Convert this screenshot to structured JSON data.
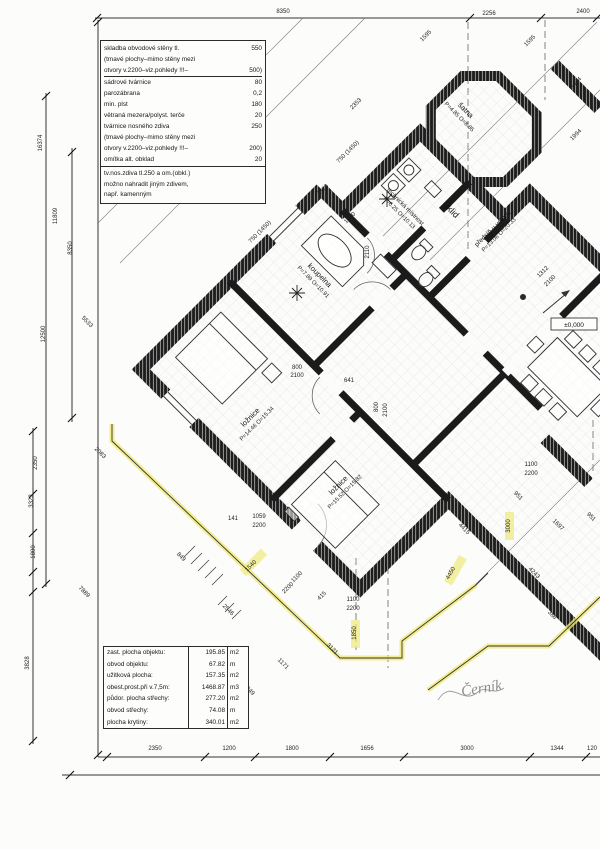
{
  "spec_box": {
    "lines": [
      {
        "l": "skladba obvodové stěny tl.",
        "v": "550"
      },
      {
        "l": "(tmavé plochy–mimo stěny mezi",
        "v": ""
      },
      {
        "l": "otvory v.2200–viz.pohledy !!!–",
        "v": "500)"
      },
      {
        "l": "sádrové tvárnice",
        "v": "80"
      },
      {
        "l": "parozábrana",
        "v": "0,2"
      },
      {
        "l": "min. plst",
        "v": "180"
      },
      {
        "l": "větraná mezera/polyst. terče",
        "v": "20"
      },
      {
        "l": "tvárnice nosného zdiva",
        "v": "250"
      },
      {
        "l": "(tmavé plochy–mimo stěny mezi",
        "v": ""
      },
      {
        "l": "otvory v.2200–viz.pohledy !!!–",
        "v": "200)"
      },
      {
        "l": "omítka alt. obklad",
        "v": "20"
      }
    ],
    "notes": [
      "tv.nos.zdiva tl.250 a om.(obkl.)",
      "možno nahradit jiným zdivem,",
      "např. kamenným"
    ]
  },
  "area_table": {
    "rows": [
      {
        "label": "zast. plocha objektu:",
        "value": "195.85",
        "unit": "m2"
      },
      {
        "label": "obvod objektu:",
        "value": "67.82",
        "unit": "m"
      },
      {
        "label": "užitková plocha:",
        "value": "157.35",
        "unit": "m2"
      },
      {
        "label": "obest.prost.při v.7,5m:",
        "value": "1468.87",
        "unit": "m3"
      },
      {
        "label": "půdor. plocha střechy:",
        "value": "277.20",
        "unit": "m2"
      },
      {
        "label": "obvod střechy:",
        "value": "74.08",
        "unit": "m"
      },
      {
        "label": "plocha krytiny:",
        "value": "340.01",
        "unit": "m2"
      }
    ]
  },
  "rooms": [
    {
      "n": "koupelna",
      "s": "P=7.89  O=10.91",
      "x": 318,
      "y": 277,
      "r": 45
    },
    {
      "n": "ložnice",
      "s": "P=14.46  O=15.34",
      "x": 252,
      "y": 419,
      "r": -45
    },
    {
      "n": "ložnice",
      "s": "P=15.52  O=15.82",
      "x": 340,
      "y": 487,
      "r": -45
    },
    {
      "n": "technická místnost",
      "s": "P=6.25  O=10.13",
      "x": 404,
      "y": 208,
      "r": 45,
      "fs": 6
    },
    {
      "n": "úklid",
      "x": 449,
      "y": 212,
      "r": 45,
      "fs": 9
    },
    {
      "n": "šatna",
      "s": "P=4.85  O=8.85",
      "x": 464,
      "y": 112,
      "r": 45
    },
    {
      "n": "předsíň u vstupu",
      "s": "P=13.06  O=20.33",
      "x": 494,
      "y": 230,
      "r": -45,
      "fs": 6.5
    }
  ],
  "dims": [
    [
      "8350",
      283,
      13,
      0
    ],
    [
      "2256",
      489,
      15,
      0
    ],
    [
      "2400",
      583,
      13,
      0
    ],
    [
      "1595",
      427,
      37,
      -45
    ],
    [
      "1595",
      531,
      42,
      -45
    ],
    [
      "1694",
      577,
      84,
      -45
    ],
    [
      "1994",
      577,
      136,
      -45
    ],
    [
      "2353",
      357,
      105,
      -45
    ],
    [
      "16374",
      42,
      143,
      -90
    ],
    [
      "11809",
      57,
      216,
      -90
    ],
    [
      "8350",
      72,
      248,
      -90
    ],
    [
      "12500",
      45,
      334,
      -90
    ],
    [
      "2350",
      37,
      463,
      -90
    ],
    [
      "3323",
      33,
      501,
      -90
    ],
    [
      "1800",
      35,
      552,
      -90
    ],
    [
      "3828",
      29,
      663,
      -90
    ],
    [
      "2350",
      155,
      750,
      0
    ],
    [
      "1200",
      229,
      750,
      0
    ],
    [
      "1800",
      292,
      750,
      0
    ],
    [
      "1656",
      367,
      750,
      0
    ],
    [
      "3000",
      467,
      750,
      0
    ],
    [
      "1344",
      557,
      750,
      0
    ],
    [
      "120",
      592,
      750,
      0
    ],
    [
      "750 (1450)",
      349,
      153,
      -45
    ],
    [
      "750 (1450)",
      261,
      233,
      -45
    ],
    [
      "2123",
      324,
      191,
      -45
    ],
    [
      "1060",
      351,
      219,
      -45
    ],
    [
      "2110",
      369,
      252,
      -90
    ],
    [
      "800",
      297,
      369,
      0
    ],
    [
      "2100",
      297,
      377,
      0
    ],
    [
      "641",
      349,
      382,
      0
    ],
    [
      "800",
      378,
      407,
      -90
    ],
    [
      "2100",
      387,
      410,
      -90
    ],
    [
      "1100",
      531,
      466,
      0
    ],
    [
      "2200",
      531,
      475,
      0
    ],
    [
      "1312",
      544,
      273,
      -45
    ],
    [
      "2100",
      551,
      282,
      -45
    ],
    [
      "5533",
      86,
      323,
      45
    ],
    [
      "2083",
      99,
      454,
      45
    ],
    [
      "141",
      233,
      520,
      0
    ],
    [
      "1059",
      259,
      518,
      0
    ],
    [
      "2200",
      259,
      527,
      0
    ],
    [
      "7889",
      83,
      593,
      45
    ],
    [
      "849",
      180,
      558,
      45
    ],
    [
      "2546",
      227,
      611,
      45
    ],
    [
      "1540",
      252,
      567,
      -45
    ],
    [
      "1100",
      298,
      578,
      -45
    ],
    [
      "2200",
      289,
      589,
      -45
    ],
    [
      "415",
      323,
      597,
      -45
    ],
    [
      "1100",
      353,
      601,
      0
    ],
    [
      "2200",
      353,
      610,
      0
    ],
    [
      "1850",
      356,
      633,
      -90
    ],
    [
      "3121",
      331,
      650,
      45
    ],
    [
      "1171",
      282,
      665,
      45
    ],
    [
      "849",
      249,
      692,
      45
    ],
    [
      "4415",
      463,
      530,
      45
    ],
    [
      "3000",
      510,
      526,
      -90
    ],
    [
      "4450",
      452,
      574,
      -60
    ],
    [
      "4243",
      533,
      574,
      45
    ],
    [
      "951",
      517,
      497,
      45
    ],
    [
      "951",
      590,
      518,
      45
    ],
    [
      "1697",
      557,
      526,
      45
    ],
    [
      "388",
      551,
      616,
      45
    ]
  ],
  "level_marker": "±0,000",
  "signature": "Černík",
  "colors": {
    "highlight": "#efe97a",
    "line": "#2b2b2b",
    "wall": "#1d1d1d",
    "grid": "#dcdcdc"
  }
}
